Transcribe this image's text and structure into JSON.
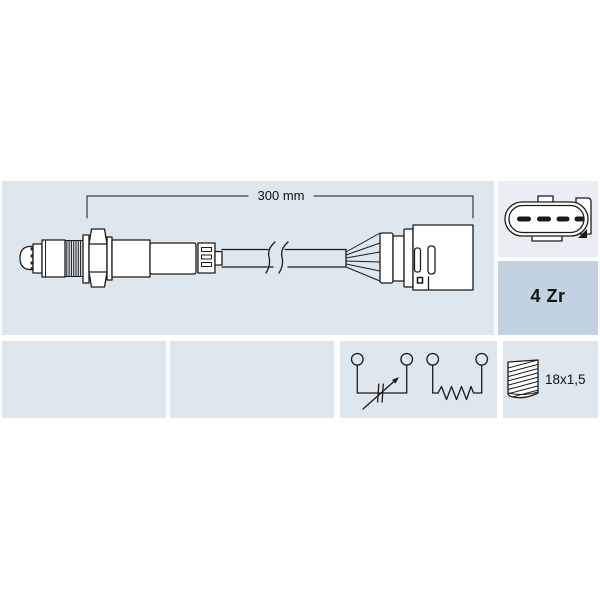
{
  "colors": {
    "page_bg": "#ffffff",
    "cell_bg": "#dee6ee",
    "connector_cell_bg": "#e9eef4",
    "code_cell_bg": "#c2d2e0",
    "line": "#1b1b1b",
    "text": "#111111"
  },
  "main_panel": {
    "dimension_label": "300 mm"
  },
  "side_panel": {
    "code_label": "4 Zr"
  },
  "spec_panel": {
    "thread_label": "18x1,5"
  },
  "icons": {
    "sensor_drawing": "oxygen-lambda-sensor-side-view",
    "connector_drawing": "4-pin-oval-connector-face",
    "schematic_drawing": "variable-resistor-and-heater-symbols",
    "thread_drawing": "screw-thread-glyph"
  }
}
